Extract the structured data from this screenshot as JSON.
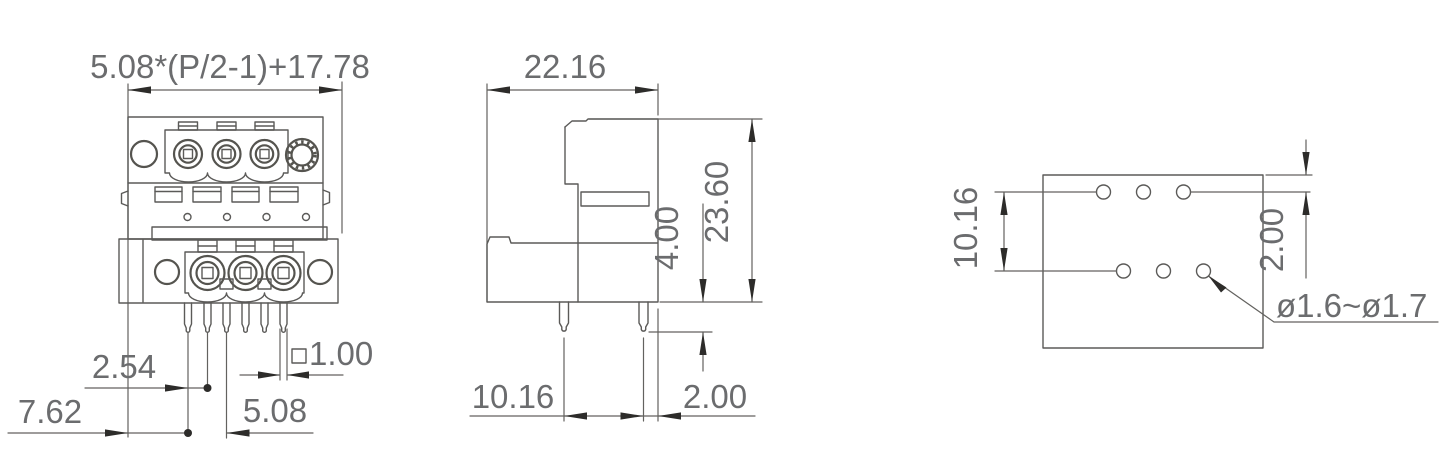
{
  "front_view": {
    "width_formula": "5.08*(P/2-1)+17.78",
    "pin_pitch": "2.54",
    "row_spacing": "7.62",
    "pole_pitch": "5.08",
    "pin_cross_section": "1.00"
  },
  "side_view": {
    "width": "22.16",
    "total_height": "23.60",
    "pin_protrusion": "4.00",
    "row_pitch": "10.16",
    "pin_edge_offset": "2.00"
  },
  "pcb_view": {
    "row_pitch": "10.16",
    "edge_offset": "2.00",
    "hole_diameter": "ø1.6~ø1.7"
  }
}
